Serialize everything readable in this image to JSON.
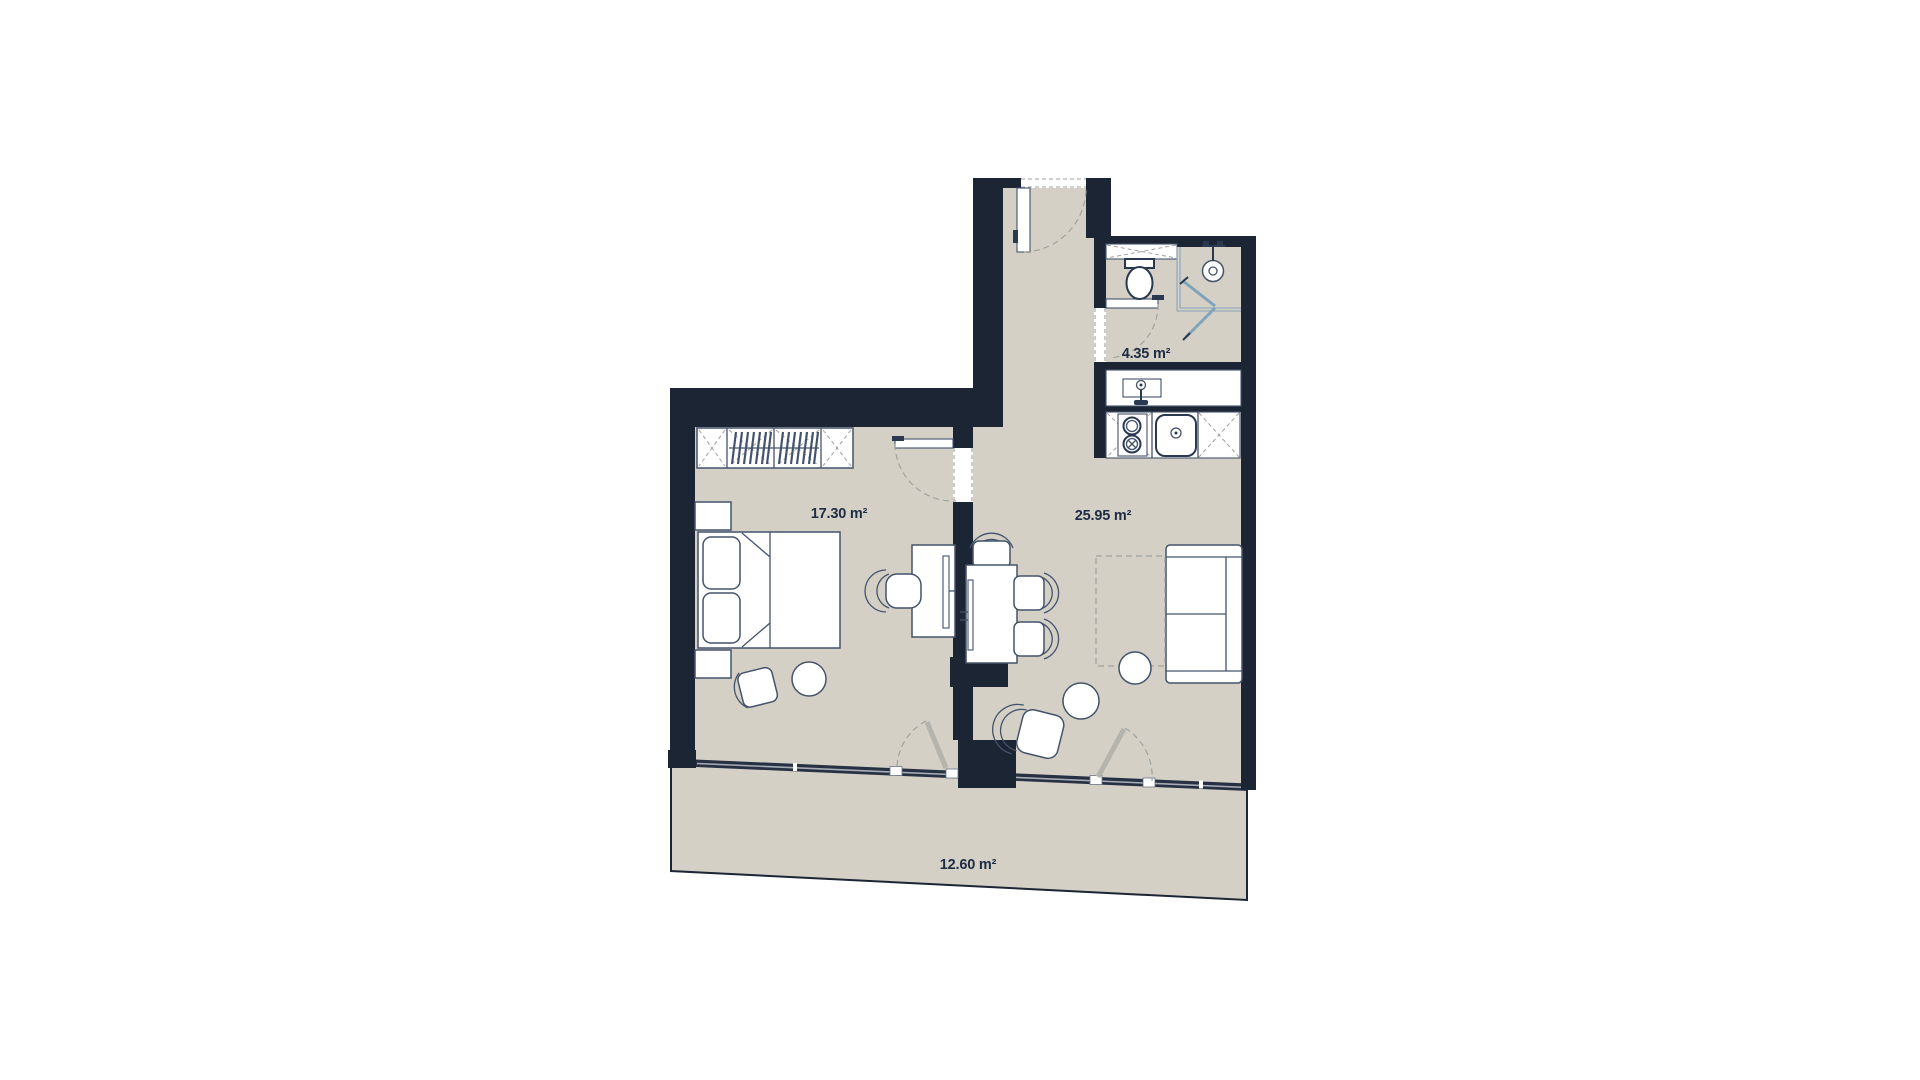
{
  "plan": {
    "type": "apartment-floor-plan",
    "rooms": [
      {
        "id": "bedroom",
        "area_label": "17.30 m²"
      },
      {
        "id": "living-room-kitchen",
        "area_label": "25.95 m²"
      },
      {
        "id": "bathroom",
        "area_label": "4.35 m²"
      },
      {
        "id": "balcony",
        "area_label": "12.60 m²"
      }
    ]
  },
  "colors": {
    "wall": "#1c2534",
    "floor": "#d4d0c6",
    "outline": "#44536b",
    "outline_strong": "#2b3950",
    "dash": "#9fa3a1",
    "door_leaf": "#b4b4ac",
    "glass": "#7fa3bd",
    "glass_light": "#93abbc",
    "window_band": "#273143",
    "window_core": "#a7adb8",
    "label": "#1e2c44",
    "background": "#ffffff"
  }
}
